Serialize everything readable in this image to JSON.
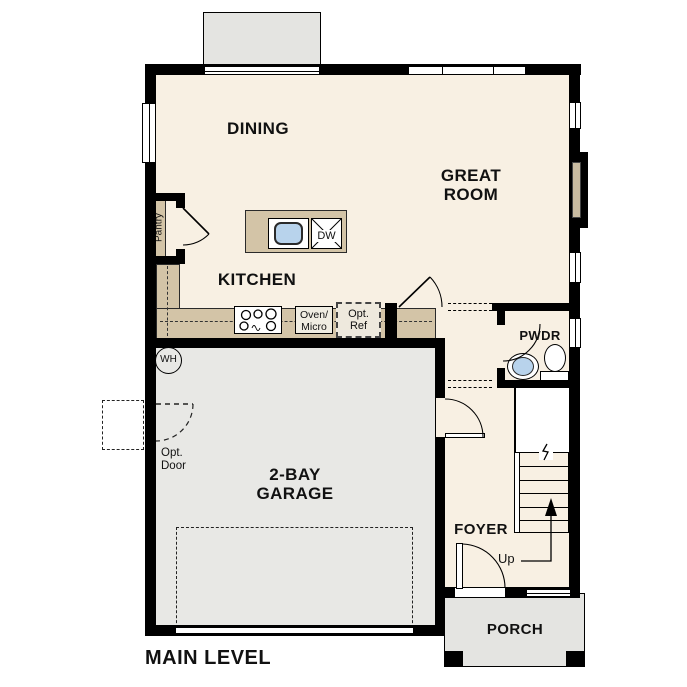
{
  "plan": {
    "title": "MAIN LEVEL",
    "rooms": {
      "dining": "DINING",
      "great_room": {
        "line1": "GREAT",
        "line2": "ROOM"
      },
      "kitchen": "KITCHEN",
      "pantry": "Pantry",
      "powder": "PWDR",
      "garage": {
        "line1": "2-BAY",
        "line2": "GARAGE"
      },
      "foyer": "FOYER",
      "porch": "PORCH"
    },
    "fixtures": {
      "dishwasher": "DW",
      "water_heater": "WH",
      "oven_micro": {
        "line1": "Oven/",
        "line2": "Micro"
      },
      "optional_fridge": {
        "line1": "Opt.",
        "line2": "Ref"
      },
      "optional_door": {
        "line1": "Opt.",
        "line2": "Door"
      },
      "stair_direction": "Up"
    },
    "colors": {
      "floor": "#f8f0e3",
      "garage_floor": "#e8e8e5",
      "outdoor": "#e4e4e1",
      "counter": "#d3c4a7",
      "fireplace": "#c9bca1",
      "sink": "#b8d3ec",
      "wall": "#000000"
    }
  }
}
